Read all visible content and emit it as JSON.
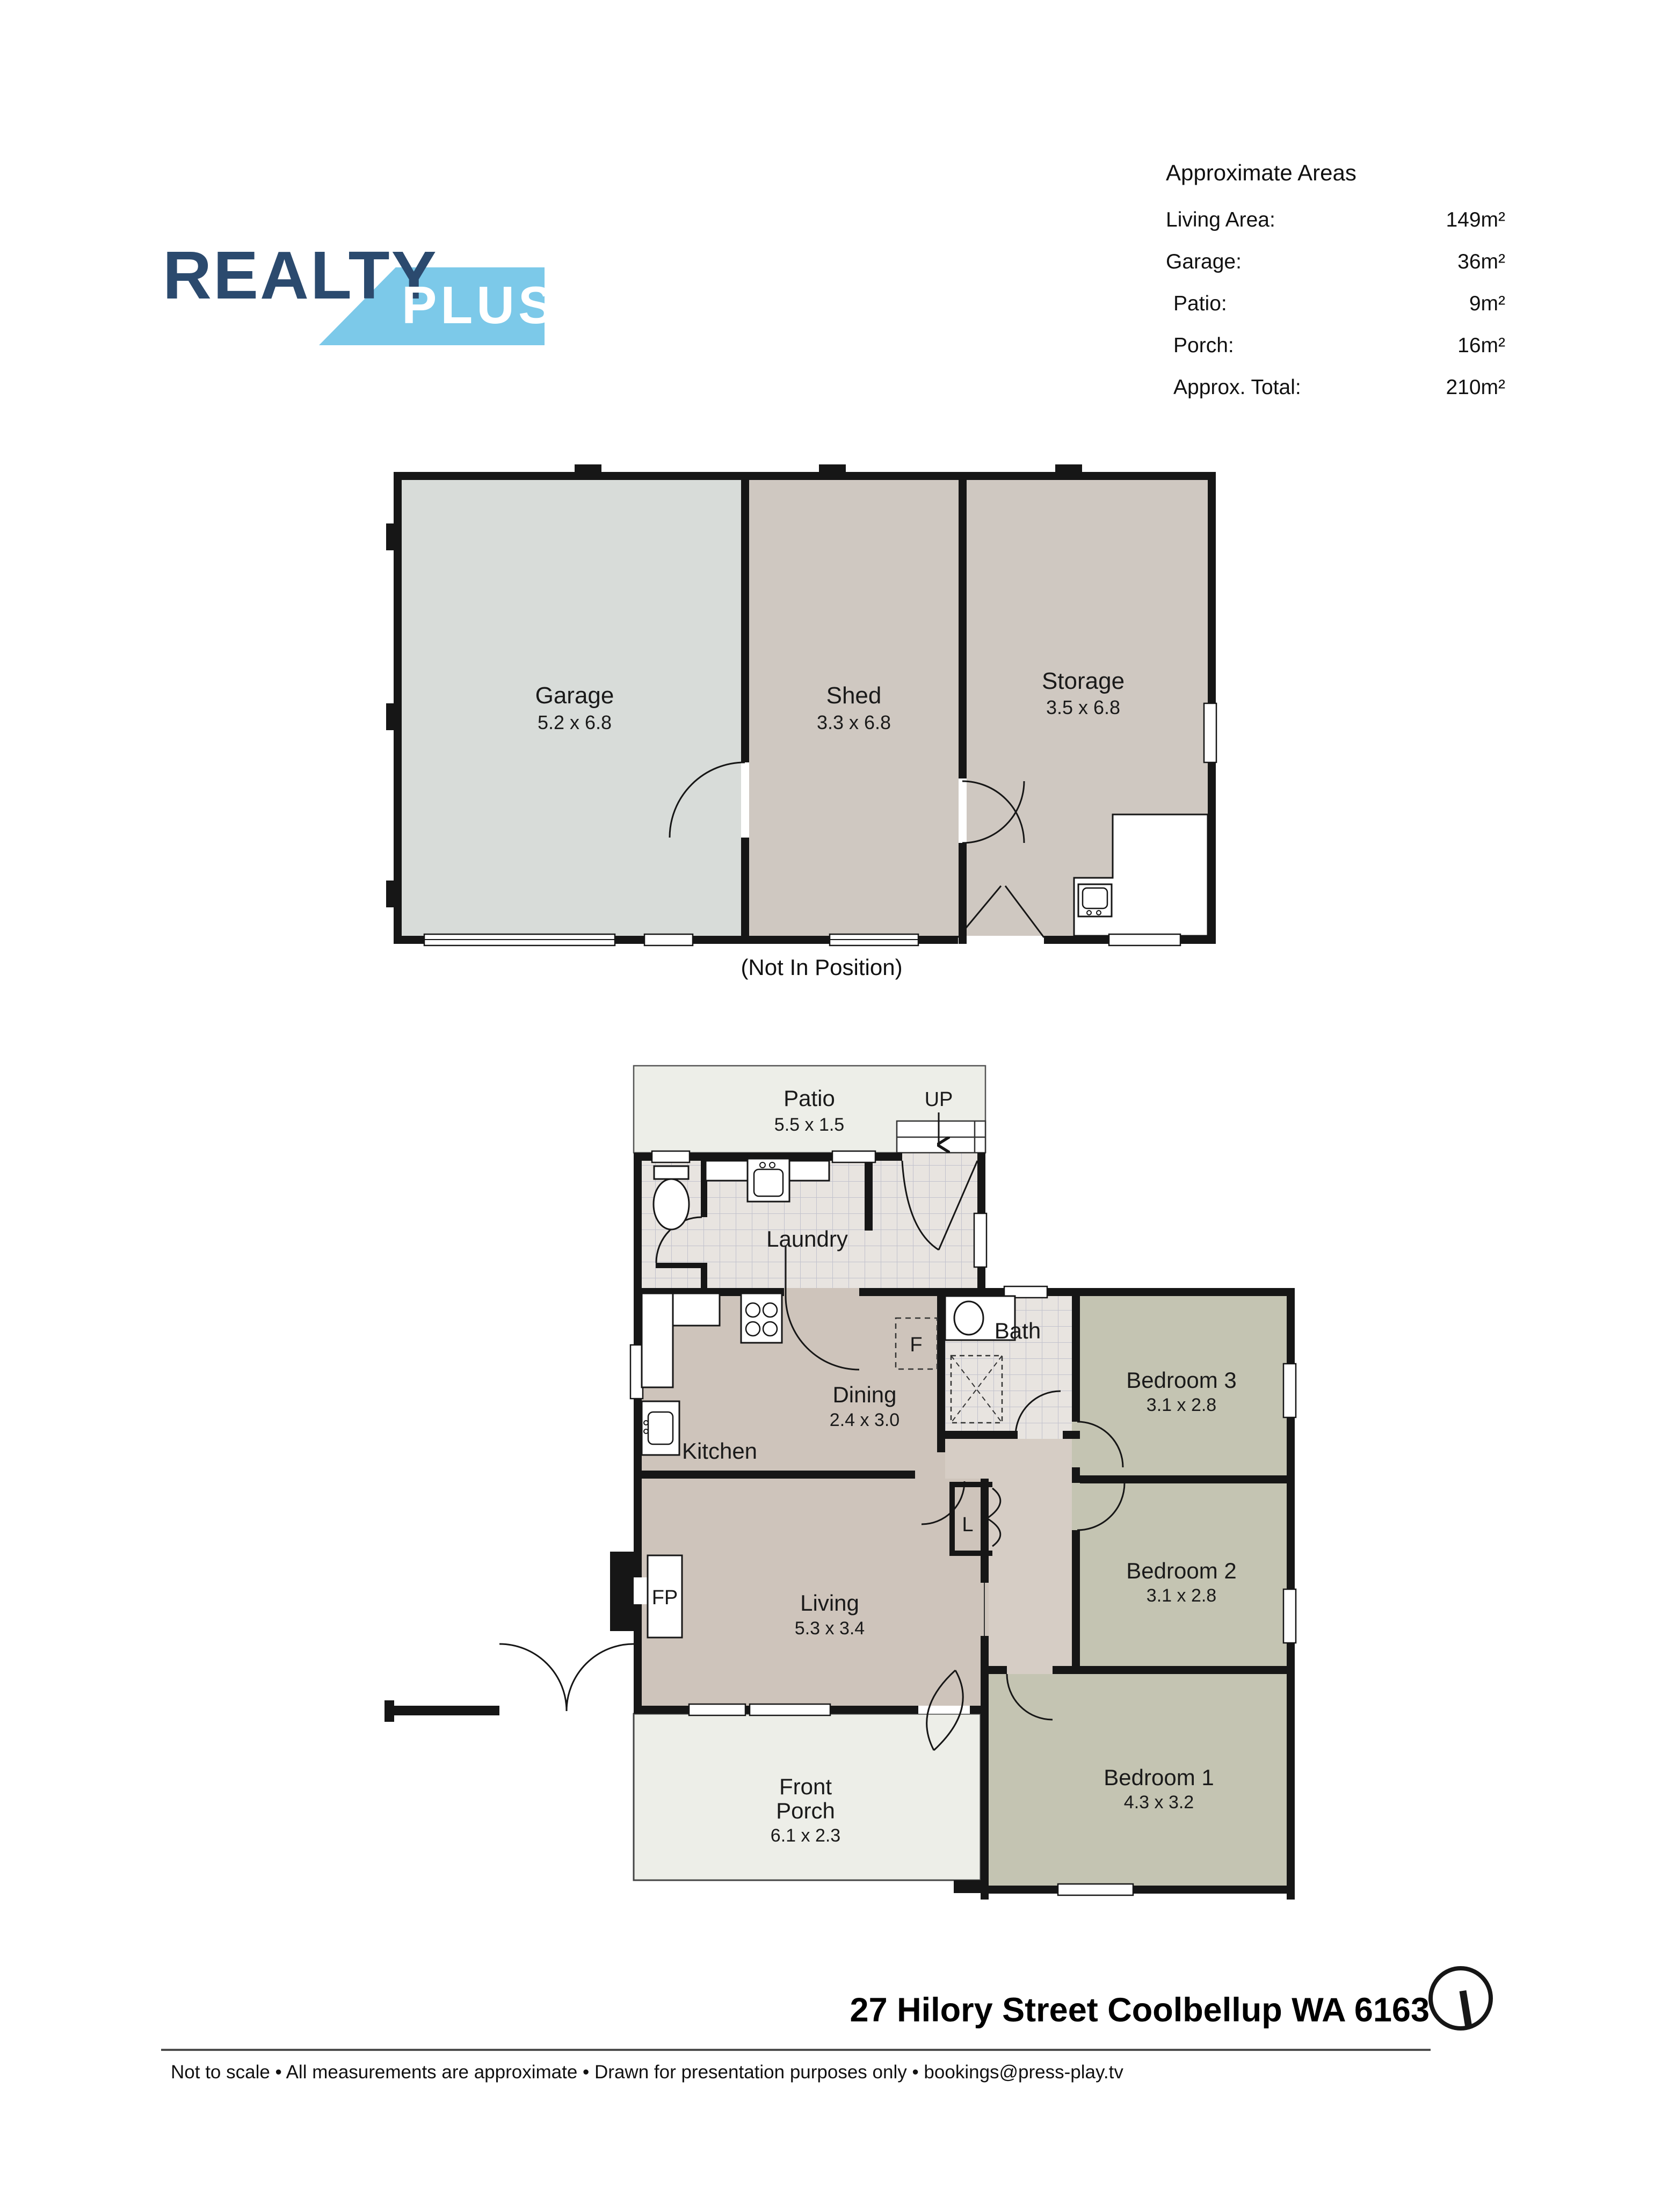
{
  "logo": {
    "brand_line1": "REALTY",
    "brand_line2": "PLUS"
  },
  "areas": {
    "title": "Approximate Areas",
    "rows": [
      {
        "label": "Living Area:",
        "value": "149m²"
      },
      {
        "label": "Garage:",
        "value": "36m²"
      },
      {
        "label": "Patio:",
        "value": "9m²"
      },
      {
        "label": "Porch:",
        "value": "16m²"
      },
      {
        "label": "Approx. Total:",
        "value": "210m²"
      }
    ]
  },
  "outbuilding": {
    "caption": "(Not In Position)",
    "rooms": {
      "garage": {
        "name": "Garage",
        "dims": "5.2 x 6.8"
      },
      "shed": {
        "name": "Shed",
        "dims": "3.3 x 6.8"
      },
      "storage": {
        "name": "Storage",
        "dims": "3.5 x 6.8"
      }
    }
  },
  "house": {
    "rooms": {
      "patio": {
        "name": "Patio",
        "dims": "5.5 x 1.5"
      },
      "laundry": {
        "name": "Laundry"
      },
      "kitchen": {
        "name": "Kitchen"
      },
      "dining": {
        "name": "Dining",
        "dims": "2.4 x 3.0"
      },
      "bath": {
        "name": "Bath"
      },
      "bed3": {
        "name": "Bedroom 3",
        "dims": "3.1 x 2.8"
      },
      "bed2": {
        "name": "Bedroom 2",
        "dims": "3.1 x 2.8"
      },
      "living": {
        "name": "Living",
        "dims": "5.3 x 3.4"
      },
      "porch": {
        "line1": "Front",
        "line2": "Porch",
        "dims": "6.1 x 2.3"
      },
      "bed1": {
        "name": "Bedroom 1",
        "dims": "4.3 x 3.2"
      }
    },
    "markers": {
      "up": "UP",
      "fridge": "F",
      "linen": "L",
      "fireplace": "FP"
    }
  },
  "footer": {
    "address": "27 Hilory Street Coolbellup WA 6163",
    "disclaimer": "Not to scale • All measurements are approximate • Drawn for presentation purposes only • bookings@press-play.tv"
  },
  "colors": {
    "brand_navy": "#2b4a6e",
    "brand_blue": "#7cc9e9",
    "wall": "#161616",
    "taupe": "#cec4bb",
    "hall": "#d6cdc5",
    "bedroom": "#c4c4b2",
    "patio_porch": "#edeee8",
    "garage_fill": "#d8dcd9",
    "shed_fill": "#cfc8c1",
    "tile": "#e8e4e0"
  }
}
